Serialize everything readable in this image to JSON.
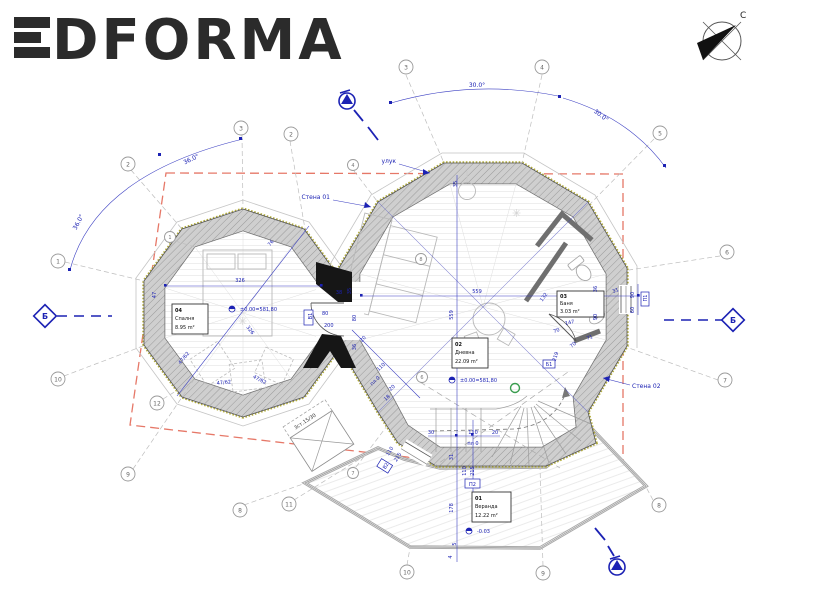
{
  "logo": {
    "text": "DFORMA"
  },
  "compass": {
    "north": "С"
  },
  "section_markers": {
    "label": "Б"
  },
  "wall_labels": {
    "wall01": "Стена 01",
    "wall02": "Стена 02",
    "gutter": "улук"
  },
  "angles": {
    "a30": "30.0°",
    "a36": "36.0°"
  },
  "rooms": {
    "bedroom": {
      "id": "04",
      "name": "Спалня",
      "area": "8.95 m²"
    },
    "living": {
      "id": "02",
      "name": "Дневна",
      "area": "22.09 m²"
    },
    "bath": {
      "id": "03",
      "name": "Баня",
      "area": "3.03 m²"
    },
    "veranda": {
      "id": "01",
      "name": "Веранда",
      "area": "12.22 m²"
    }
  },
  "levels": {
    "ground": "±0.00=581,80",
    "veranda": "-0.03"
  },
  "openings": {
    "door1": {
      "tag": "В1"
    },
    "door2": {
      "tag": "В2"
    },
    "win1": {
      "tag": "П1"
    },
    "win2": {
      "tag": "П2"
    }
  },
  "notes": {
    "b1": "Б1",
    "steps": "3ст.15/30",
    "floor0": "пл 0"
  },
  "dims": {
    "v326": "326",
    "v559": "559",
    "v4762": "47/62",
    "v147": "147",
    "v70": "70",
    "v71": "71",
    "v132": "132",
    "v36": "36",
    "v90": "90",
    "v31": "31",
    "v35": "35",
    "v38": "38",
    "v30": "30",
    "v20": "20",
    "v18": "18",
    "v178": "178",
    "v219": "219",
    "v76": "76",
    "v47": "47",
    "v4": "4",
    "v5": "5",
    "v110": "110",
    "v80": "80",
    "v200": "200",
    "v215": "215",
    "v60": "60"
  },
  "grid": {
    "bubbles": [
      {
        "label": "1"
      },
      {
        "label": "2"
      },
      {
        "label": "3"
      },
      {
        "label": "2"
      },
      {
        "label": "1"
      },
      {
        "label": "3"
      },
      {
        "label": "4"
      },
      {
        "label": "4"
      },
      {
        "label": "5"
      },
      {
        "label": "6"
      },
      {
        "label": "7"
      },
      {
        "label": "8"
      },
      {
        "label": "9"
      },
      {
        "label": "10"
      },
      {
        "label": "11"
      },
      {
        "label": "7"
      },
      {
        "label": "8"
      },
      {
        "label": "9"
      },
      {
        "label": "10"
      },
      {
        "label": "12"
      },
      {
        "label": "6"
      },
      {
        "label": "8"
      }
    ]
  }
}
